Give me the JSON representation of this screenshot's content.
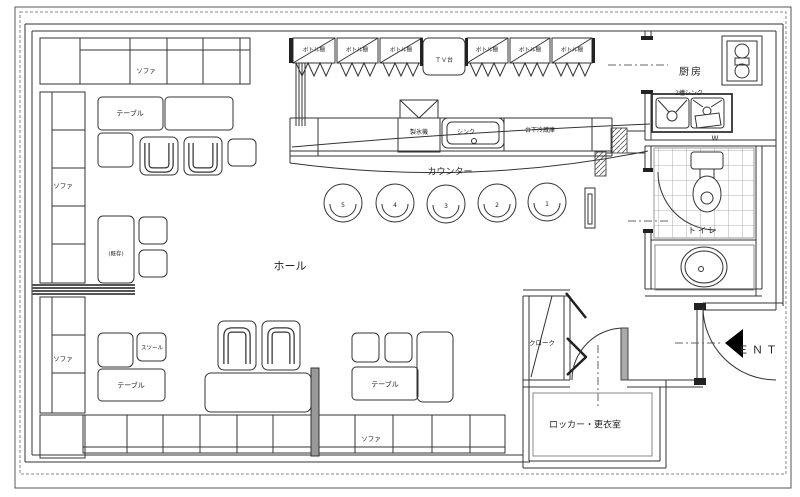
{
  "colors": {
    "ink": "#333333",
    "paper": "#ffffff"
  },
  "hall": {
    "name": "ホール",
    "sofa_top": "ソファ",
    "sofa_left_upper": "ソファ",
    "sofa_left_lower": "ソファ",
    "sofa_bottom": "ソファ",
    "table_top": "テーブル",
    "table_bottom_left": "テーブル",
    "table_bottom_center": "テーブル",
    "stool": "スツール",
    "existing_table": "(既存)"
  },
  "bar": {
    "counter": "カウンター",
    "bottle_shelves": [
      "ボトル棚",
      "ボトル棚",
      "ボトル棚",
      "ボトル棚",
      "ボトル棚",
      "ボトル棚"
    ],
    "tv_stand": "ＴＶ台",
    "ice_maker": "製氷機",
    "sink": "シンク",
    "under_counter_fridge": "台下冷蔵庫",
    "stool_numbers": [
      "5",
      "4",
      "3",
      "2",
      "1"
    ]
  },
  "kitchen": {
    "name": "厨房",
    "double_sink": "2槽シンク",
    "w_mark": "W"
  },
  "toilet": {
    "name": "トイレ"
  },
  "back": {
    "cloak": "クローク",
    "locker_room": "ロッカー・更衣室"
  },
  "entrance": {
    "ent": "ＥＮＴ"
  }
}
